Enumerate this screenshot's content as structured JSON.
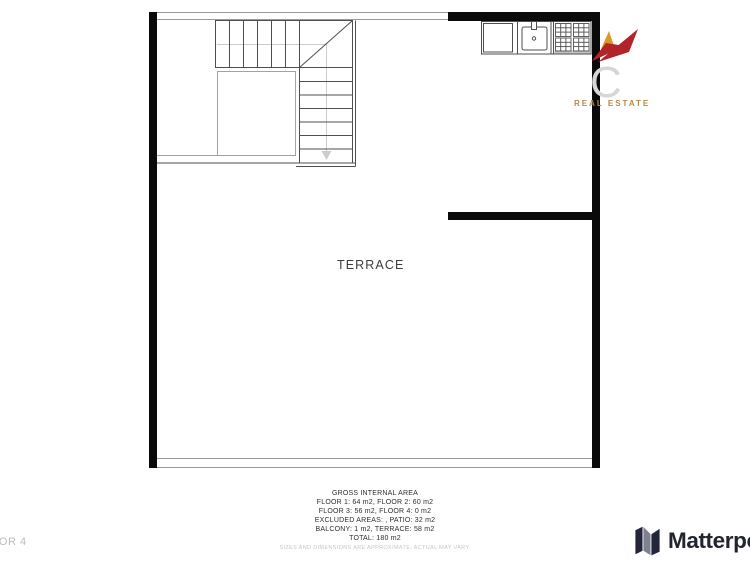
{
  "brand": {
    "initial": "C",
    "tagline": "REAL ESTATE",
    "mark_colors": {
      "red": "#b2232a",
      "gold": "#d99b26"
    },
    "initial_color": "#d6d6d6",
    "tagline_color": "#b5894b"
  },
  "plan": {
    "room_label": "TERRACE",
    "floor_label": "FLOOR 4",
    "wall_color": "#0a0a0a",
    "fixtures": [
      "staircase",
      "kitchen-counter",
      "cabinet",
      "sink",
      "stove-4-burners"
    ]
  },
  "footer": {
    "area_summary": {
      "title": "GROSS INTERNAL AREA",
      "lines": [
        "FLOOR 1: 64 m2, FLOOR 2: 60 m2",
        "FLOOR 3: 56 m2, FLOOR 4: 0 m2",
        "EXCLUDED AREAS: , PATIO: 32 m2",
        "BALCONY: 1 m2, TERRACE: 58 m2",
        "TOTAL: 180 m2"
      ],
      "disclaimer": "SIZES AND DIMENSIONS ARE APPROXIMATE, ACTUAL MAY VARY."
    },
    "matterport_wordmark": "Matterport"
  }
}
